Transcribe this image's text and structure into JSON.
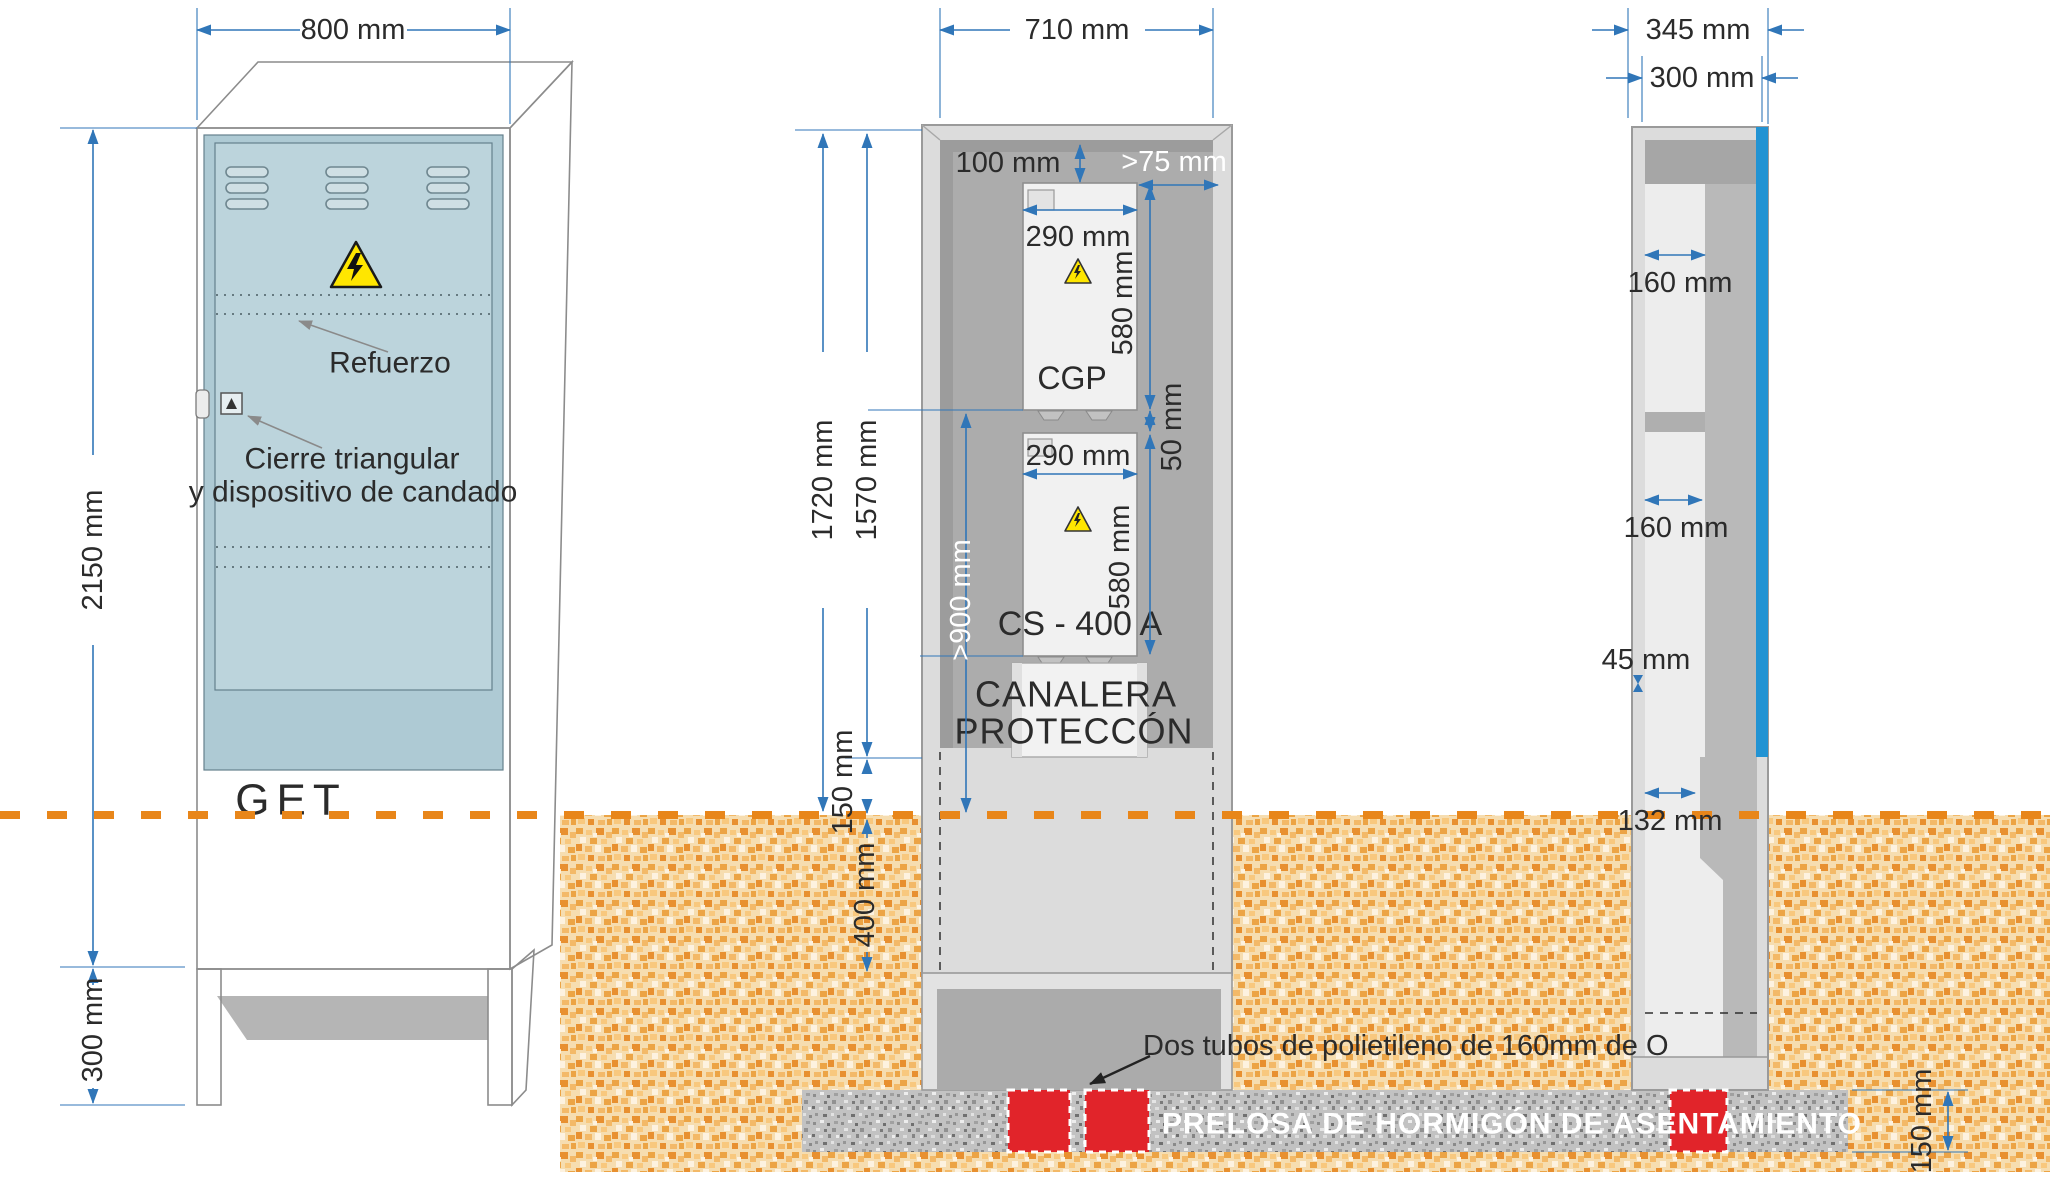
{
  "front_view": {
    "width_dim": "800 mm",
    "height_dim": "2150 mm",
    "base_dim": "300 mm",
    "reinforcement_label": "Refuerzo",
    "lock_label_line1": "Cierre triangular",
    "lock_label_line2": "y dispositivo de candado",
    "brand": "GET"
  },
  "section_view": {
    "width_dim": "710 mm",
    "top_gap_dim": "100 mm",
    "side_gap_dim": ">75 mm",
    "cgp_width_dim": "290 mm",
    "cgp_height_dim": "580 mm",
    "cgp_label": "CGP",
    "gap_dim": "50 mm",
    "cs_width_dim": "290 mm",
    "cs_height_dim": "580 mm",
    "cs_label": "CS - 400 A",
    "duct_label_line1": "CANALERA",
    "duct_label_line2": "PROTECCÓN",
    "total_height_dim": "1720 mm",
    "inner_height_dim": "1570 mm",
    "min_height_dim": ">900 mm",
    "above_ground_dim": "150 mm",
    "buried_dim": "400 mm"
  },
  "side_view": {
    "outer_width_dim": "345 mm",
    "inner_width_dim": "300 mm",
    "upper_depth_dim": "160 mm",
    "lower_depth_dim": "160 mm",
    "wall_dim": "45 mm",
    "buried_depth_dim": "132 mm"
  },
  "foundation": {
    "tubes_label": "Dos tubos de polietileno de 160mm de O",
    "slab_label": "PRELOSA DE HORMIGÓN DE ASENTAMIENTO",
    "slab_thickness_dim": "150 mm"
  },
  "colors": {
    "dimension_blue": "#3076b8",
    "ground_orange": "#e8861a",
    "tube_red": "#e1242a",
    "door_blue": "#aecad4",
    "accent_blue_strip": "#2293d3",
    "warning_yellow": "#ffe600"
  }
}
